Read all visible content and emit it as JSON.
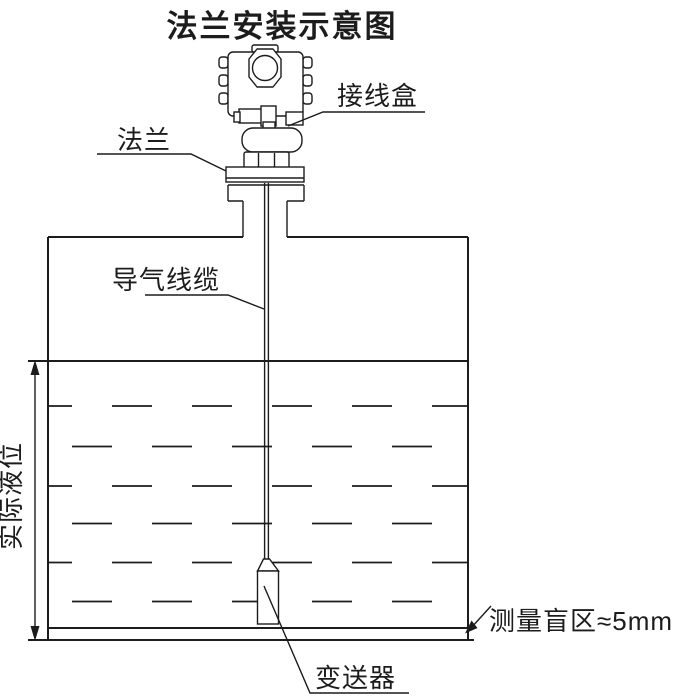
{
  "diagram": {
    "title": "法兰安装示意图",
    "labels": {
      "junction_box": "接线盒",
      "flange": "法兰",
      "air_cable": "导气线缆",
      "actual_level": "实际液位",
      "blind_zone": "测量盲区≈5mm",
      "transmitter": "变送器"
    },
    "colors": {
      "line": "#1c1c1c",
      "background": "#ffffff"
    }
  }
}
